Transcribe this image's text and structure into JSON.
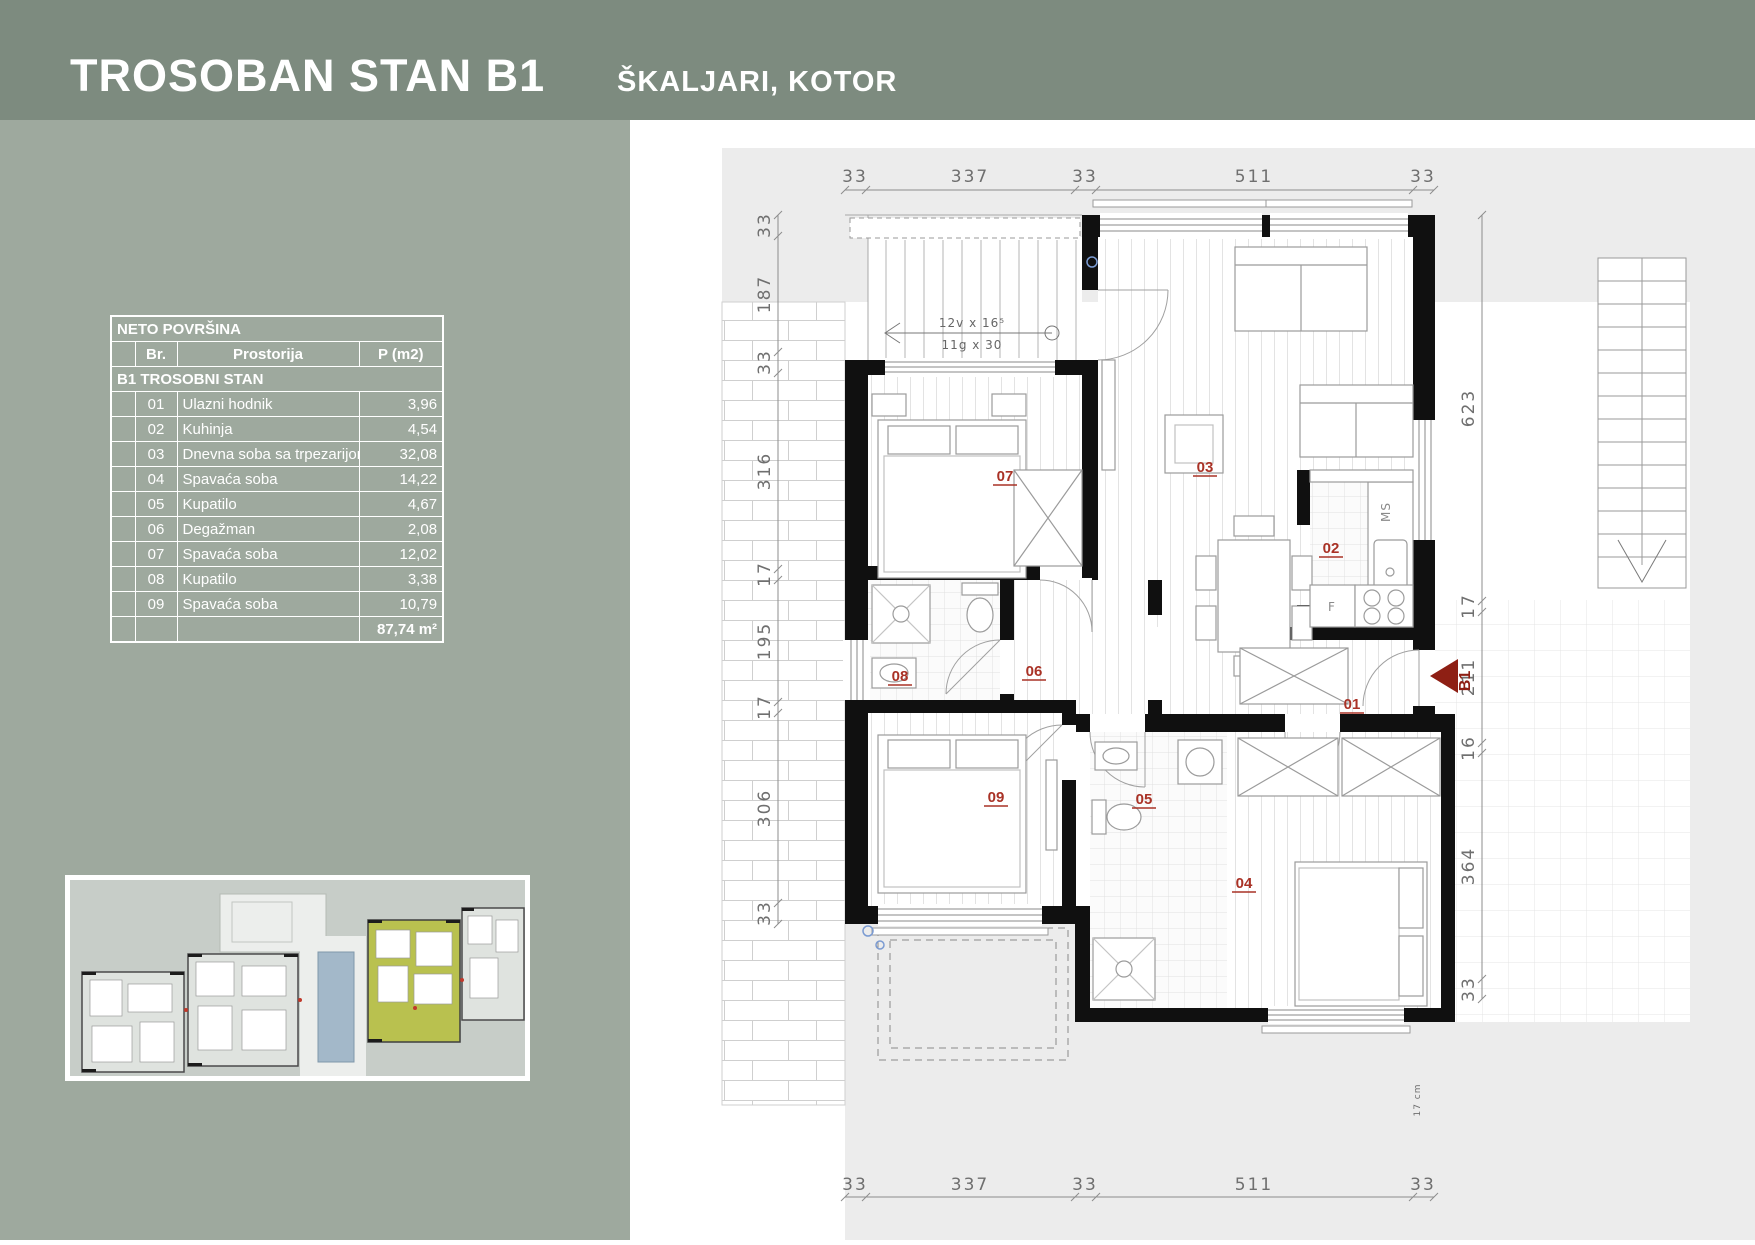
{
  "header": {
    "title": "TROSOBAN STAN B1",
    "subtitle": "ŠKALJARI, KOTOR"
  },
  "area_table": {
    "title": "NETO POVRŠINA",
    "columns": {
      "br": "Br.",
      "room": "Prostorija",
      "area": "P (m2)"
    },
    "section": "B1 TROSOBNI STAN",
    "rows": [
      {
        "br": "01",
        "room": "Ulazni hodnik",
        "area": "3,96"
      },
      {
        "br": "02",
        "room": "Kuhinja",
        "area": "4,54"
      },
      {
        "br": "03",
        "room": "Dnevna soba sa trpezarijom",
        "area": "32,08"
      },
      {
        "br": "04",
        "room": "Spavaća soba",
        "area": "14,22"
      },
      {
        "br": "05",
        "room": "Kupatilo",
        "area": "4,67"
      },
      {
        "br": "06",
        "room": "Degažman",
        "area": "2,08"
      },
      {
        "br": "07",
        "room": "Spavaća soba",
        "area": "12,02"
      },
      {
        "br": "08",
        "room": "Kupatilo",
        "area": "3,38"
      },
      {
        "br": "09",
        "room": "Spavaća soba",
        "area": "10,79"
      }
    ],
    "total": "87,74 m²"
  },
  "plan": {
    "unit_marker": "B1",
    "room_labels": {
      "r01": "01",
      "r02": "02",
      "r03": "03",
      "r04": "04",
      "r05": "05",
      "r06": "06",
      "r07": "07",
      "r08": "08",
      "r09": "09"
    },
    "annotations": {
      "stair_line1": "12v x 16⁵",
      "stair_line2": "11g x 30",
      "ms": "MS",
      "fridge": "F",
      "cm_note": "17 cm"
    },
    "dims": {
      "top": [
        "33",
        "337",
        "33",
        "511",
        "33"
      ],
      "bottom": [
        "33",
        "337",
        "33",
        "511",
        "33"
      ],
      "left": [
        "33",
        "187",
        "33",
        "316",
        "17",
        "195",
        "17",
        "306",
        "33"
      ],
      "right": [
        "623",
        "17",
        "211",
        "16",
        "364",
        "33"
      ]
    }
  },
  "colors": {
    "header_bg": "#7d8b7f",
    "panel_bg": "#9ea99e",
    "accent_red": "#a93226",
    "marker_red": "#8e1f14",
    "site_highlight": "#b9c14f",
    "pool_blue": "#a3b8c9"
  }
}
